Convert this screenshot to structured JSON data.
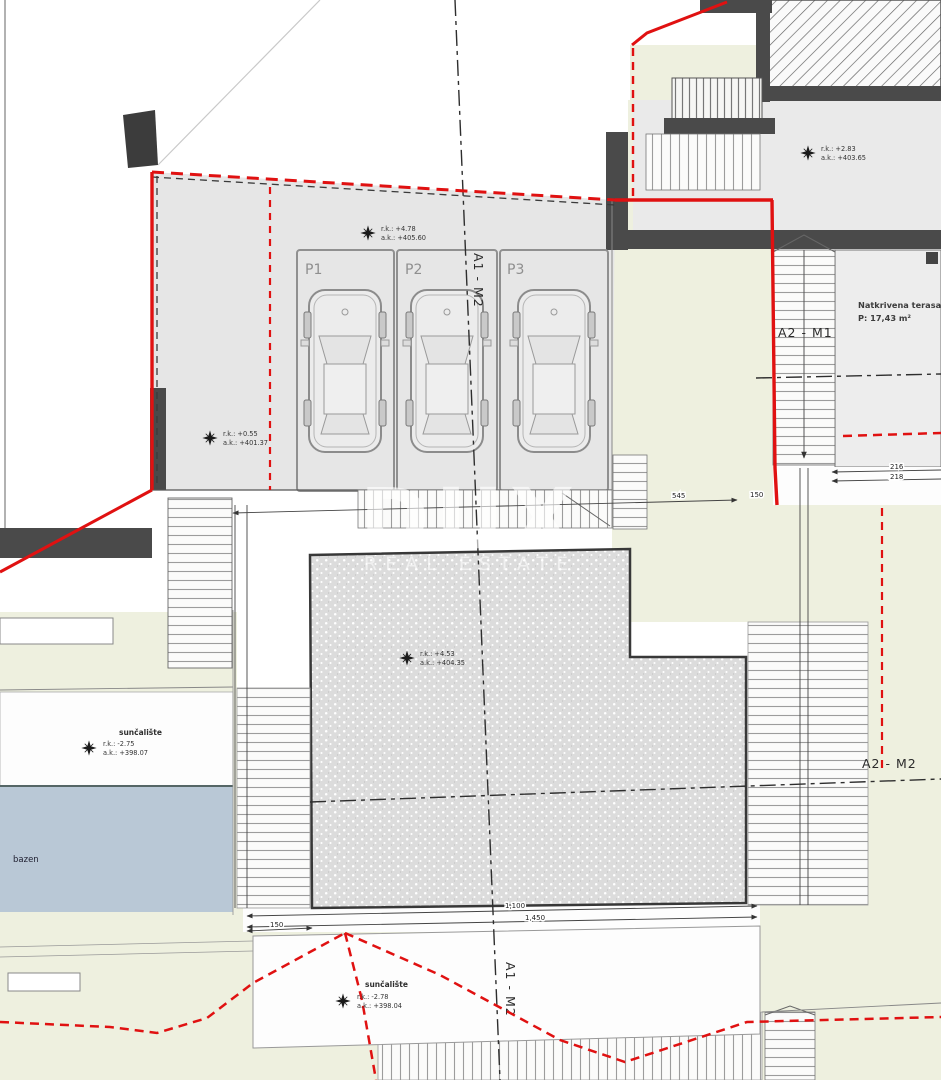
{
  "plan": {
    "watermark": {
      "line1": "DUX",
      "line2": "REAL ESTATE"
    },
    "axis_labels": {
      "a1m2": "A1 - M2",
      "a2m1": "A2 - M1",
      "a2m2": "A2 - M2"
    },
    "parking": {
      "p1": "P1",
      "p2": "P2",
      "p3": "P3"
    },
    "terrace": {
      "name": "Natkrivena terasa",
      "area": "P: 17,43 m²"
    },
    "pool_label": "bazen",
    "markers": {
      "parking": {
        "rk": "r.k.: +4.78",
        "ak": "a.k.: +405.60"
      },
      "upper_right": {
        "rk": "r.k.: +2.83",
        "ak": "a.k.: +403.65"
      },
      "left": {
        "rk": "r.k.: +0.55",
        "ak": "a.k.: +401.37"
      },
      "building": {
        "rk": "r.k.: +4.53",
        "ak": "a.k.: +404.35"
      },
      "sun_left": {
        "title": "sunčalište",
        "rk": "r.k.: -2.75",
        "ak": "a.k.: +398.07"
      },
      "sun_bottom": {
        "title": "sunčalište",
        "rk": "r.k.: -2.78",
        "ak": "a.k.: +398.04"
      }
    },
    "dims": {
      "d545": "545",
      "d150a": "150",
      "d216": "216",
      "d218": "218",
      "d1100": "1,100",
      "d1450": "1,450",
      "d150b": "150"
    },
    "colors": {
      "boundary_red": "#e01111",
      "cream": "#eef0df",
      "platform_gray": "#e6e6e6",
      "pool_blue": "#b9c8d6",
      "wall_dark": "#3f3f3f",
      "stipple_base": "#dcdcdc"
    }
  }
}
